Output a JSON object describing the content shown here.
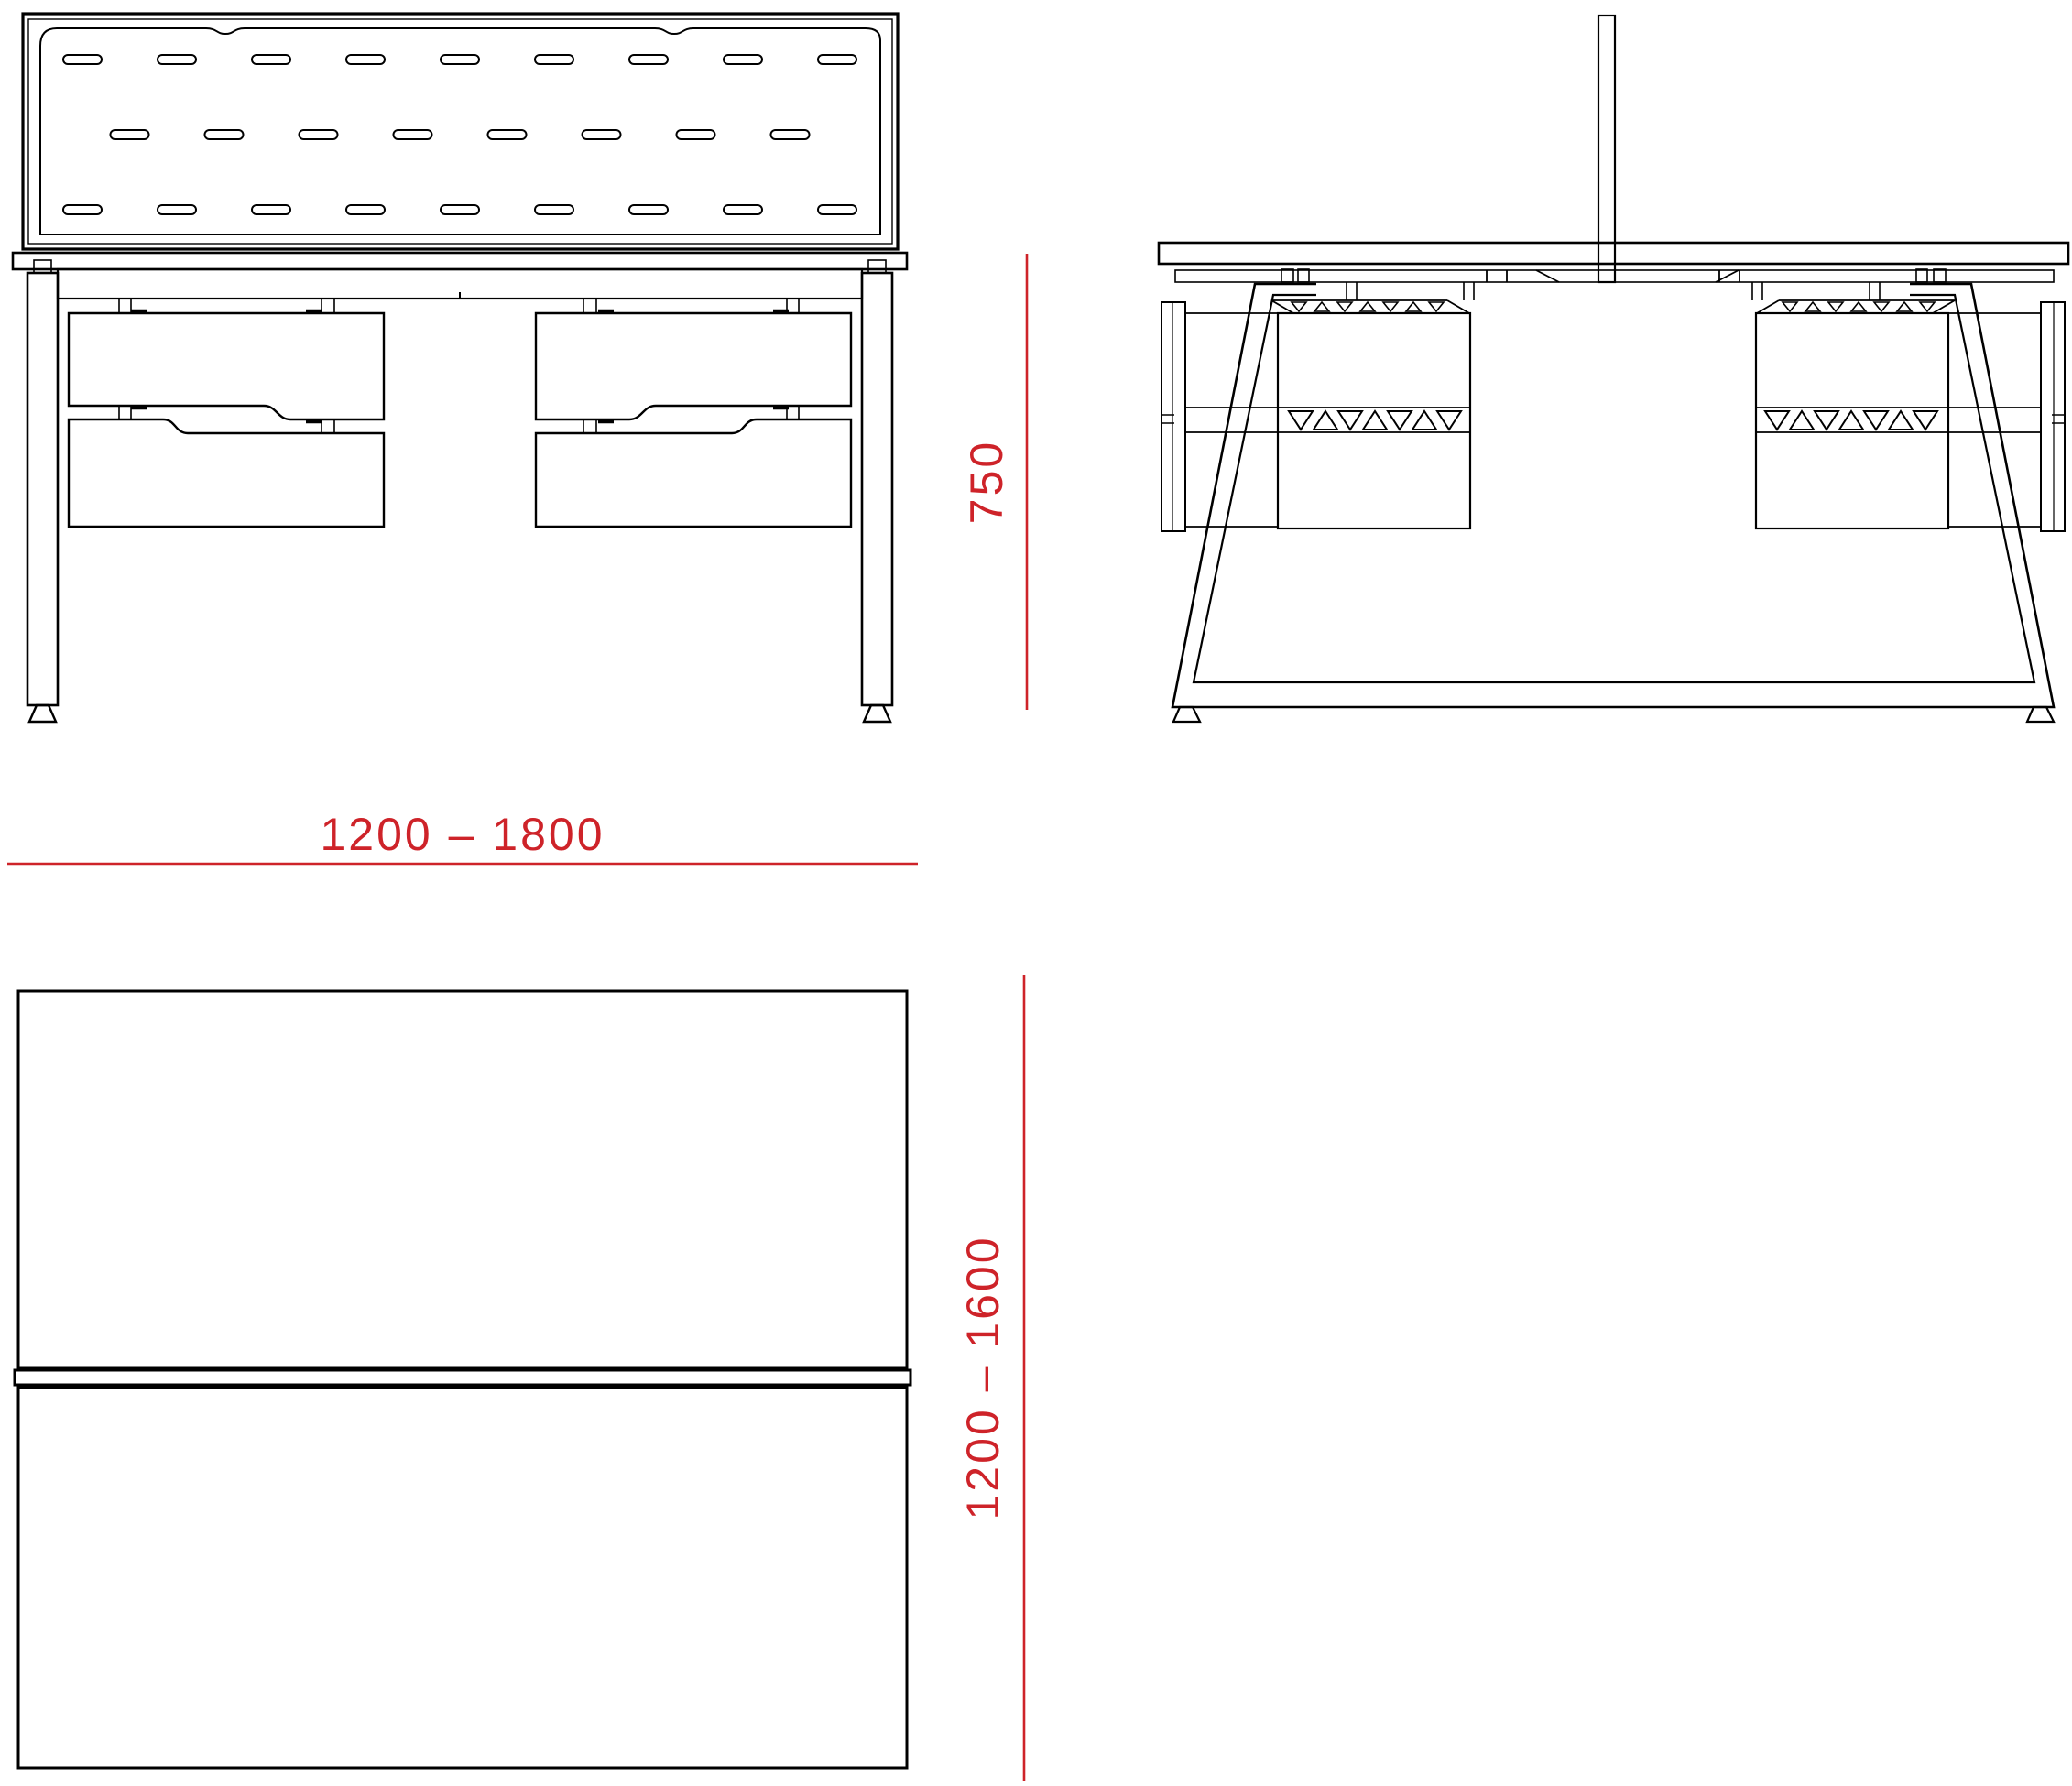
{
  "drawing": {
    "dimensions": {
      "width": {
        "label": "1200 – 1800"
      },
      "height": {
        "label": "750"
      },
      "depth": {
        "label": "1200 – 1600"
      }
    }
  },
  "colors": {
    "dimension_red": "#CE2329",
    "line_black": "#000000",
    "background": "#FFFFFF"
  }
}
